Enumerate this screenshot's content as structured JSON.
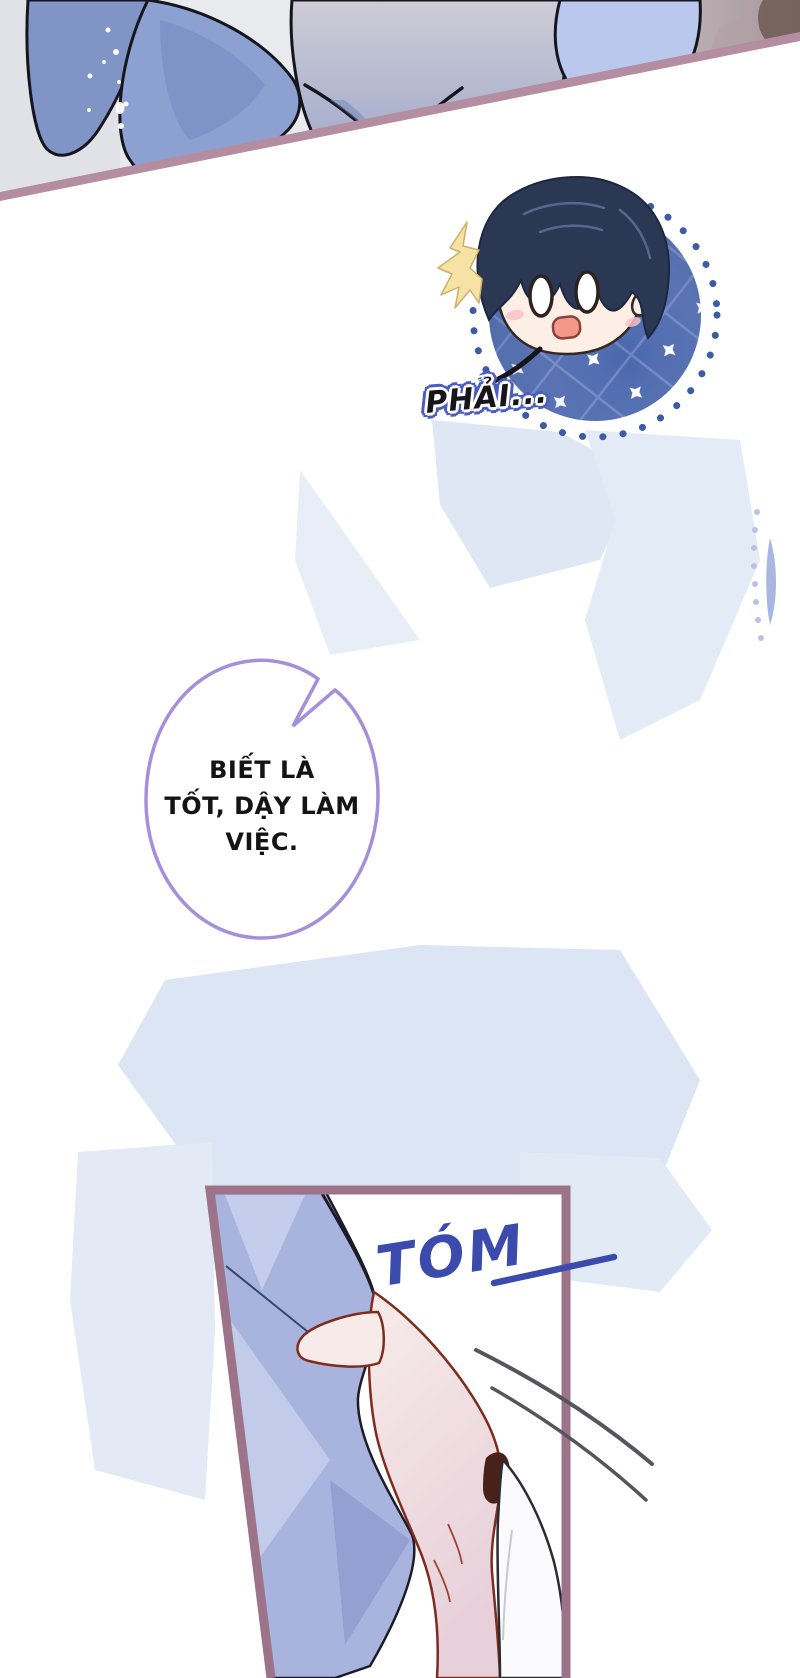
{
  "comic": {
    "inset_sfx": "PHẢI...",
    "speech_bubble": {
      "line1": "BIẾT LÀ",
      "line2": "TỐT, DẬY LÀM",
      "line3": "VIỆC."
    },
    "grab_sfx": "TÓM"
  },
  "colors": {
    "divider": "#b58da1",
    "frame_border": "#9c7389",
    "inset_circle": "#4a67ad",
    "inset_circle_grid": "#6d86c3",
    "sfx_blue": "#3a4aad",
    "sfx_outline": "#4a5cc0",
    "sfx_text": "#17151c",
    "bubble_outline": "#a48fd8",
    "bubble_text": "#141414",
    "wash": "#dfe7f4",
    "fabric": "#a9b4de",
    "skin": "#f7ebe9",
    "skin_outline": "#7e2c1e",
    "hair": "#2b3854"
  }
}
